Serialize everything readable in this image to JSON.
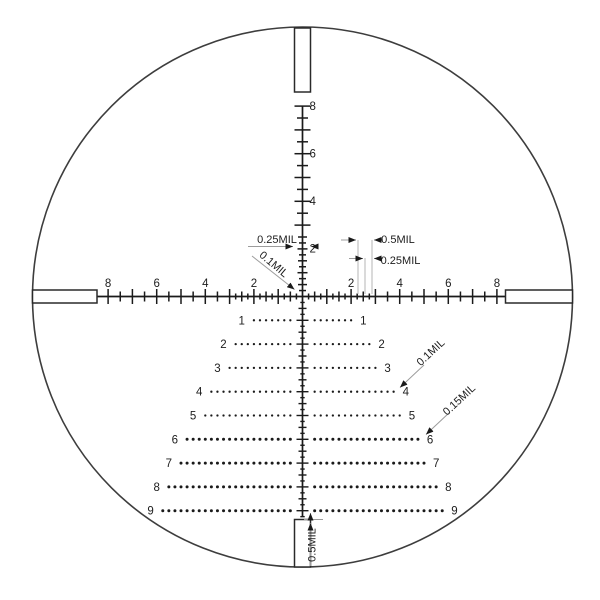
{
  "canvas": {
    "width": 600,
    "height": 600,
    "background": "#ffffff"
  },
  "style": {
    "line_color": "#1a1a1a",
    "circle_color": "#3d3d3d",
    "dim_line_color": "#9c9c9c",
    "guide_line_color": "#b4b4b4",
    "text_color": "#1d1d1d",
    "axis_font_size": 11.5,
    "dim_font_size": 11
  },
  "reticle": {
    "center_x": 302.5,
    "center_y": 296.5,
    "px_per_mil_x": 24.3,
    "px_per_mil_y": 23.8,
    "circle_radius": 270,
    "posts": [
      {
        "id": "post-top",
        "x": 294.5,
        "y": 28,
        "w": 16,
        "h": 64
      },
      {
        "id": "post-bottom",
        "x": 294.5,
        "y": 519.5,
        "w": 16,
        "h": 47.5
      },
      {
        "id": "post-left",
        "x": 32.5,
        "y": 290,
        "w": 64.5,
        "h": 13
      },
      {
        "id": "post-right",
        "x": 505.5,
        "y": 290,
        "w": 67,
        "h": 13
      }
    ],
    "h_axis": {
      "x_start": 97,
      "x_end": 507,
      "max_mil": 8,
      "fine_until_mil": 3,
      "tick_half_integer": 7.5,
      "tick_half_half": 5,
      "tick_half_quarter": 3,
      "labels": [
        2,
        4,
        6,
        8
      ],
      "label_baseline_y": 287
    },
    "v_axis_up": {
      "max_mil": 8,
      "fine_until_mil": 2.5,
      "labels": [
        2,
        4,
        6,
        8
      ],
      "label_x": 309.5,
      "half_integer_fine": 5,
      "half_half_fine": 4.5,
      "half_quarter": 3.5,
      "half_integer": 8,
      "half_half": 5.5
    },
    "v_axis_down": {
      "max_mil": 9.25,
      "half_integer": 6,
      "half_half": 4,
      "half_quarter": 2.2
    },
    "tree": {
      "dot_start_mil": 0.5,
      "dot_step_mil": 0.25,
      "dot_radius_small": 1.15,
      "dot_radius_large": 1.5,
      "large_from_row": 6,
      "label_gap_px": 9,
      "rows": [
        {
          "num": 1,
          "extent_mil": 2.0
        },
        {
          "num": 2,
          "extent_mil": 2.75
        },
        {
          "num": 3,
          "extent_mil": 3.0
        },
        {
          "num": 4,
          "extent_mil": 3.75
        },
        {
          "num": 5,
          "extent_mil": 4.0
        },
        {
          "num": 6,
          "extent_mil": 4.75
        },
        {
          "num": 7,
          "extent_mil": 5.0
        },
        {
          "num": 8,
          "extent_mil": 5.5
        },
        {
          "num": 9,
          "extent_mil": 5.75
        }
      ]
    }
  },
  "annotations": {
    "texts": [
      {
        "id": "dim-reticle-tick-width",
        "text": "0.25MIL",
        "x": 277,
        "y": 243,
        "rotate": 0
      },
      {
        "id": "dim-line-width",
        "text": "0.1MIL",
        "x": 271.5,
        "y": 267,
        "rotate": 40
      },
      {
        "id": "dim-half-mil-spacing",
        "text": "0.5MIL",
        "x": 398,
        "y": 243,
        "rotate": 0
      },
      {
        "id": "dim-quarter-mil-spacing",
        "text": "0.25MIL",
        "x": 400.5,
        "y": 264,
        "rotate": 0
      },
      {
        "id": "dim-dot-size-small",
        "text": "0.1MIL",
        "x": 433,
        "y": 355,
        "rotate": -43
      },
      {
        "id": "dim-dot-size-large",
        "text": "0.15MIL",
        "x": 461.5,
        "y": 402.5,
        "rotate": -43
      },
      {
        "id": "dim-post-gap",
        "text": "0.5MIL",
        "x": 315.5,
        "y": 545,
        "rotate": -90
      }
    ],
    "guide_lines": [
      {
        "x1": 358,
        "y1": 240,
        "x2": 358,
        "y2": 294
      },
      {
        "x1": 365,
        "y1": 258,
        "x2": 365,
        "y2": 294
      },
      {
        "x1": 372,
        "y1": 240,
        "x2": 372,
        "y2": 294
      }
    ],
    "arrow_lines": [
      {
        "x1": 341,
        "y1": 240,
        "x2": 356,
        "y2": 240
      },
      {
        "x1": 383,
        "y1": 240,
        "x2": 374,
        "y2": 240
      },
      {
        "x1": 349,
        "y1": 258.5,
        "x2": 363,
        "y2": 258.5
      },
      {
        "x1": 383,
        "y1": 258.5,
        "x2": 374,
        "y2": 258.5
      },
      {
        "x1": 248,
        "y1": 246.5,
        "x2": 293,
        "y2": 246.5
      },
      {
        "x1": 318,
        "y1": 246.5,
        "x2": 311,
        "y2": 246.5
      },
      {
        "x1": 252,
        "y1": 256,
        "x2": 294.5,
        "y2": 289.5
      },
      {
        "x1": 424,
        "y1": 365,
        "x2": 400,
        "y2": 387.5
      },
      {
        "x1": 450,
        "y1": 412,
        "x2": 426,
        "y2": 434.5
      },
      {
        "x1": 310.5,
        "y1": 566,
        "x2": 310.5,
        "y2": 523
      },
      {
        "x1": 310.5,
        "y1": 518,
        "x2": 310.5,
        "y2": 513
      }
    ],
    "plain_lines": [
      {
        "x1": 304,
        "y1": 519.5,
        "x2": 323,
        "y2": 519.5
      }
    ]
  }
}
